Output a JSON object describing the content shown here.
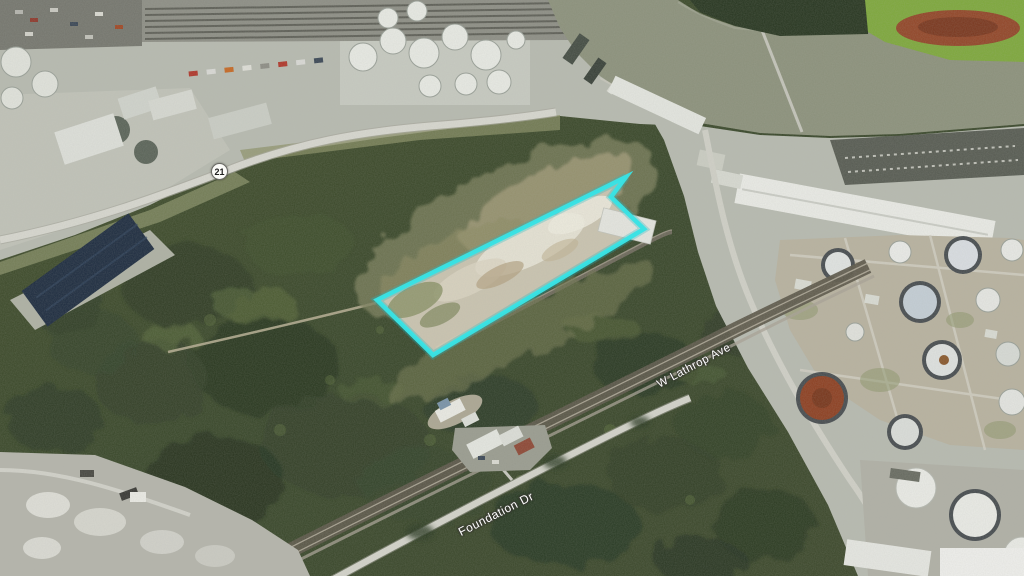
{
  "map": {
    "route_shield": {
      "label": "21"
    },
    "road_labels": {
      "lathrop": "W Lathrop Ave",
      "foundation": "Foundation Dr"
    },
    "parcel_overlay": {
      "points": "377,300 626,177 611,197 644,229 433,355",
      "stroke_color": "#39E2E4",
      "stroke_width": 4.5
    },
    "palette": {
      "forest": "#3C492E",
      "water": "#8D927D",
      "industrial": "#B7BAB0",
      "sand": "#C9C3B0",
      "marsh": "#7FA83F",
      "rust_pond": "#93492C"
    }
  }
}
